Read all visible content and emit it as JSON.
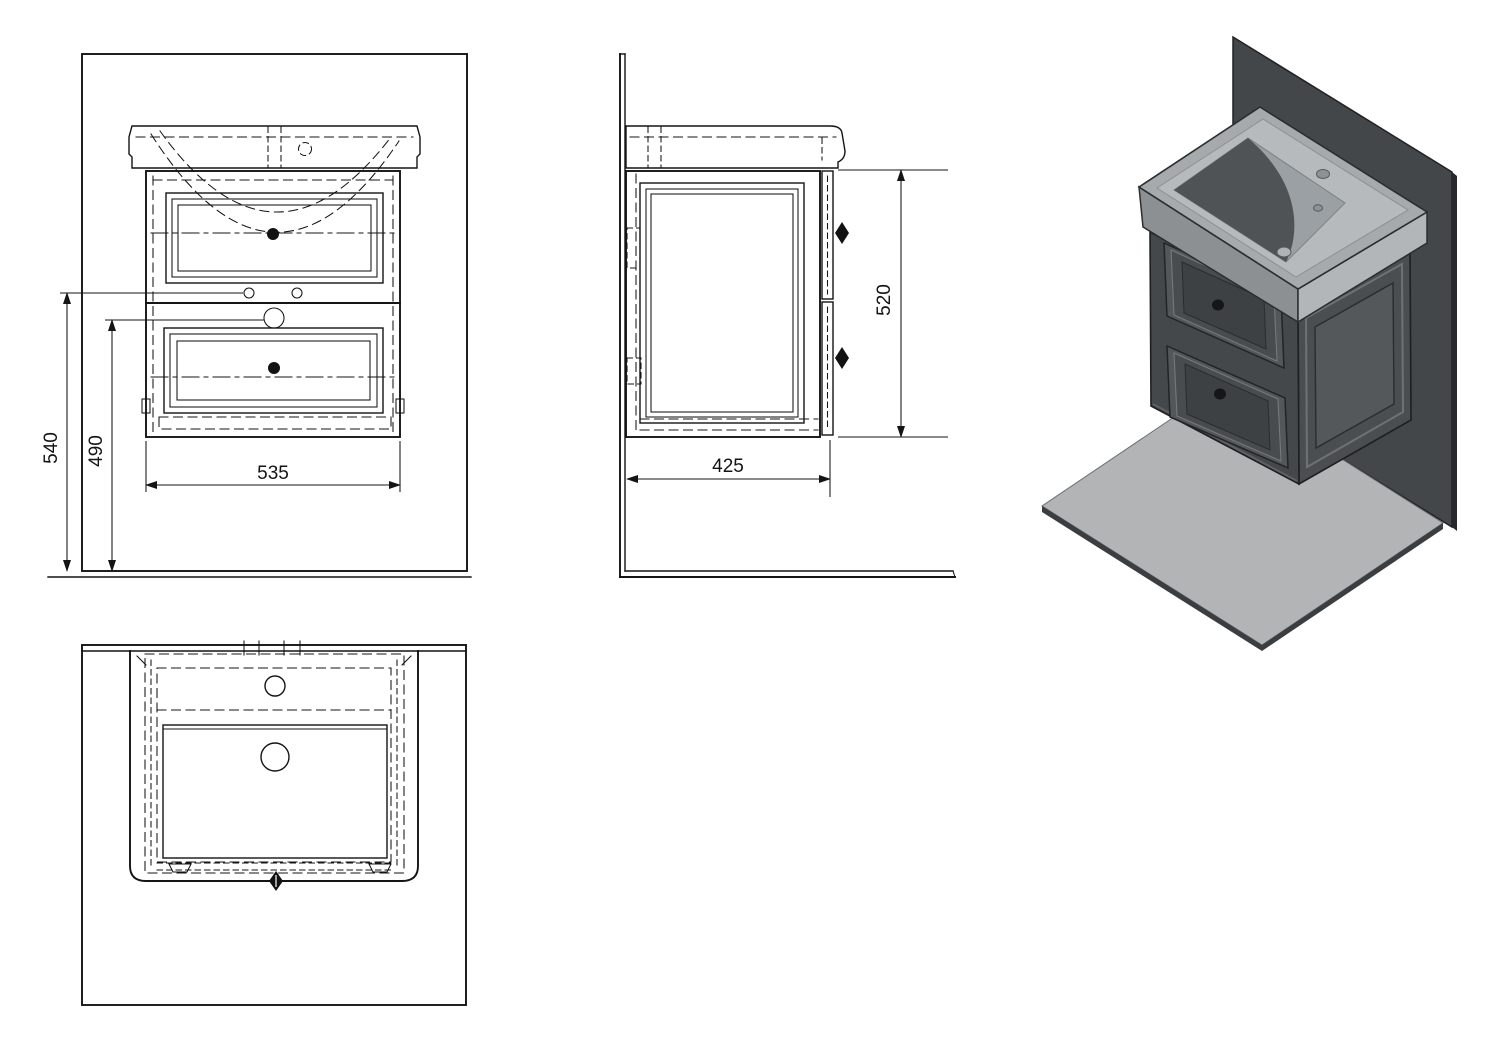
{
  "drawing": {
    "background_color": "#ffffff",
    "line_color": "#141414",
    "front_view": {
      "dim_total_height": "540",
      "dim_mount_height": "490",
      "dim_width": "535"
    },
    "side_view": {
      "dim_height": "520",
      "dim_depth": "425"
    },
    "plan_view": {},
    "iso_view": {
      "wall_color": "#43474a",
      "wall_edge_color": "#26282a",
      "floor_color": "#b2b4b6",
      "floor_edge_color": "#3b3e40",
      "cabinet_color": "#44484b",
      "drawer_face_color": "#53575a",
      "drawer_panel_color": "#3d4144",
      "basin_top_color": "#a6aaad",
      "basin_deck_color": "#b7babc",
      "bowl_color": "#9aa0a3",
      "bowl_shadow_color": "#4f5356"
    }
  }
}
